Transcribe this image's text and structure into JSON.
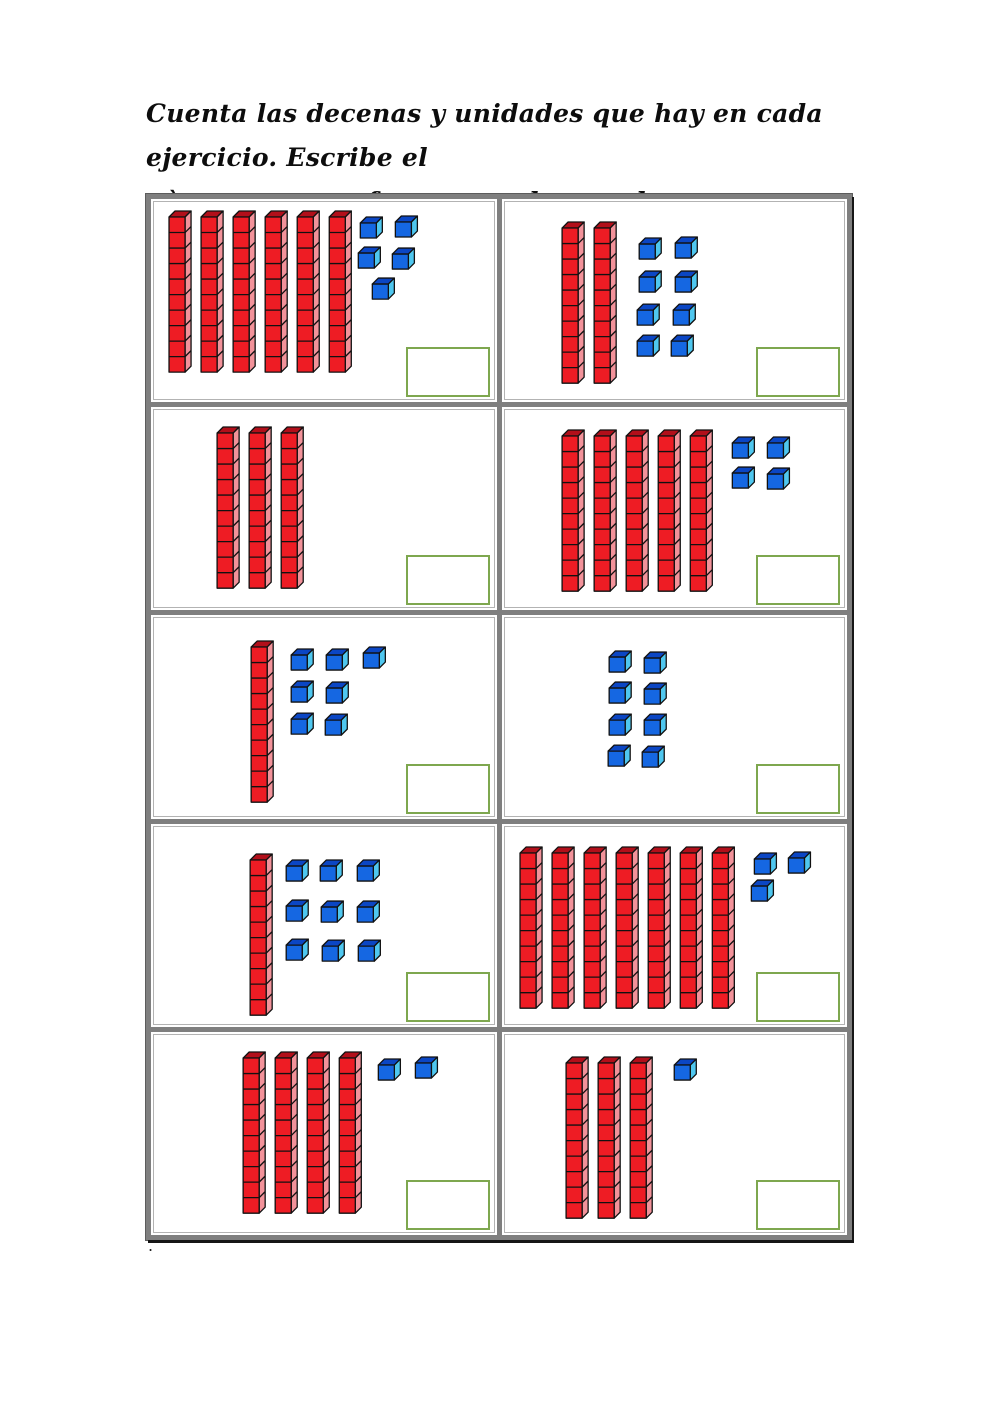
{
  "instructions": {
    "line1": "Cuenta las decenas y unidades que hay en cada ejercicio. Escribe el",
    "line2": "nùmero que se forma, en el recuadro correspondiente."
  },
  "footer": {
    "stray_dot": "."
  },
  "colors": {
    "rod_front": "#ee1c24",
    "rod_side": "#f2929a",
    "rod_top": "#b20f1a",
    "unit_front": "#1567e2",
    "unit_side": "#4fc7ef",
    "unit_top": "#0b46c4",
    "outline": "#111111",
    "answer_box_border": "#7ea74f",
    "grid_border": "#7f7f7f"
  },
  "worksheet": {
    "type": "base-ten-blocks-counting",
    "grid": {
      "rows": 5,
      "cols": 2
    },
    "cells": [
      {
        "index": 1,
        "tens": 6,
        "units": 5,
        "answer": "",
        "rod_origin": [
          18,
          12
        ],
        "unit_origin": [
          207,
          17
        ],
        "unit_offsets": [
          [
            2,
            1
          ],
          [
            37,
            0
          ],
          [
            0,
            31
          ],
          [
            34,
            32
          ],
          [
            14,
            62
          ]
        ]
      },
      {
        "index": 2,
        "tens": 2,
        "units": 8,
        "answer": "",
        "rod_origin": [
          60,
          23
        ],
        "unit_origin": [
          137,
          39
        ],
        "unit_offsets": [
          [
            0,
            0
          ],
          [
            36,
            -1
          ],
          [
            0,
            33
          ],
          [
            36,
            33
          ],
          [
            -2,
            66
          ],
          [
            34,
            66
          ],
          [
            -2,
            97
          ],
          [
            32,
            97
          ]
        ]
      },
      {
        "index": 3,
        "tens": 3,
        "units": 0,
        "answer": "",
        "rod_origin": [
          66,
          20
        ],
        "unit_origin": [
          0,
          0
        ],
        "unit_offsets": []
      },
      {
        "index": 4,
        "tens": 5,
        "units": 4,
        "answer": "",
        "rod_origin": [
          60,
          23
        ],
        "unit_origin": [
          230,
          30
        ],
        "unit_offsets": [
          [
            0,
            0
          ],
          [
            35,
            0
          ],
          [
            0,
            30
          ],
          [
            35,
            31
          ]
        ]
      },
      {
        "index": 5,
        "tens": 1,
        "units": 7,
        "answer": "",
        "rod_origin": [
          100,
          26
        ],
        "unit_origin": [
          140,
          34
        ],
        "unit_offsets": [
          [
            0,
            0
          ],
          [
            35,
            0
          ],
          [
            72,
            -2
          ],
          [
            0,
            32
          ],
          [
            35,
            33
          ],
          [
            0,
            64
          ],
          [
            34,
            65
          ]
        ]
      },
      {
        "index": 6,
        "tens": 0,
        "units": 8,
        "answer": "",
        "rod_origin": [
          0,
          0
        ],
        "unit_origin": [
          107,
          36
        ],
        "unit_offsets": [
          [
            0,
            0
          ],
          [
            35,
            1
          ],
          [
            0,
            31
          ],
          [
            35,
            32
          ],
          [
            0,
            63
          ],
          [
            35,
            63
          ],
          [
            -1,
            94
          ],
          [
            33,
            95
          ]
        ]
      },
      {
        "index": 7,
        "tens": 1,
        "units": 9,
        "answer": "",
        "rod_origin": [
          99,
          30
        ],
        "unit_origin": [
          135,
          36
        ],
        "unit_offsets": [
          [
            0,
            0
          ],
          [
            34,
            0
          ],
          [
            71,
            0
          ],
          [
            0,
            40
          ],
          [
            35,
            41
          ],
          [
            71,
            41
          ],
          [
            0,
            79
          ],
          [
            36,
            80
          ],
          [
            72,
            80
          ]
        ]
      },
      {
        "index": 8,
        "tens": 7,
        "units": 3,
        "answer": "",
        "rod_origin": [
          18,
          23
        ],
        "unit_origin": [
          252,
          28
        ],
        "unit_offsets": [
          [
            0,
            1
          ],
          [
            34,
            0
          ],
          [
            -3,
            28
          ]
        ]
      },
      {
        "index": 9,
        "tens": 4,
        "units": 2,
        "answer": "",
        "rod_origin": [
          92,
          20
        ],
        "unit_origin": [
          227,
          25
        ],
        "unit_offsets": [
          [
            0,
            2
          ],
          [
            37,
            0
          ]
        ]
      },
      {
        "index": 10,
        "tens": 3,
        "units": 1,
        "answer": "",
        "rod_origin": [
          64,
          25
        ],
        "unit_origin": [
          172,
          27
        ],
        "unit_offsets": [
          [
            0,
            0
          ]
        ]
      }
    ]
  }
}
